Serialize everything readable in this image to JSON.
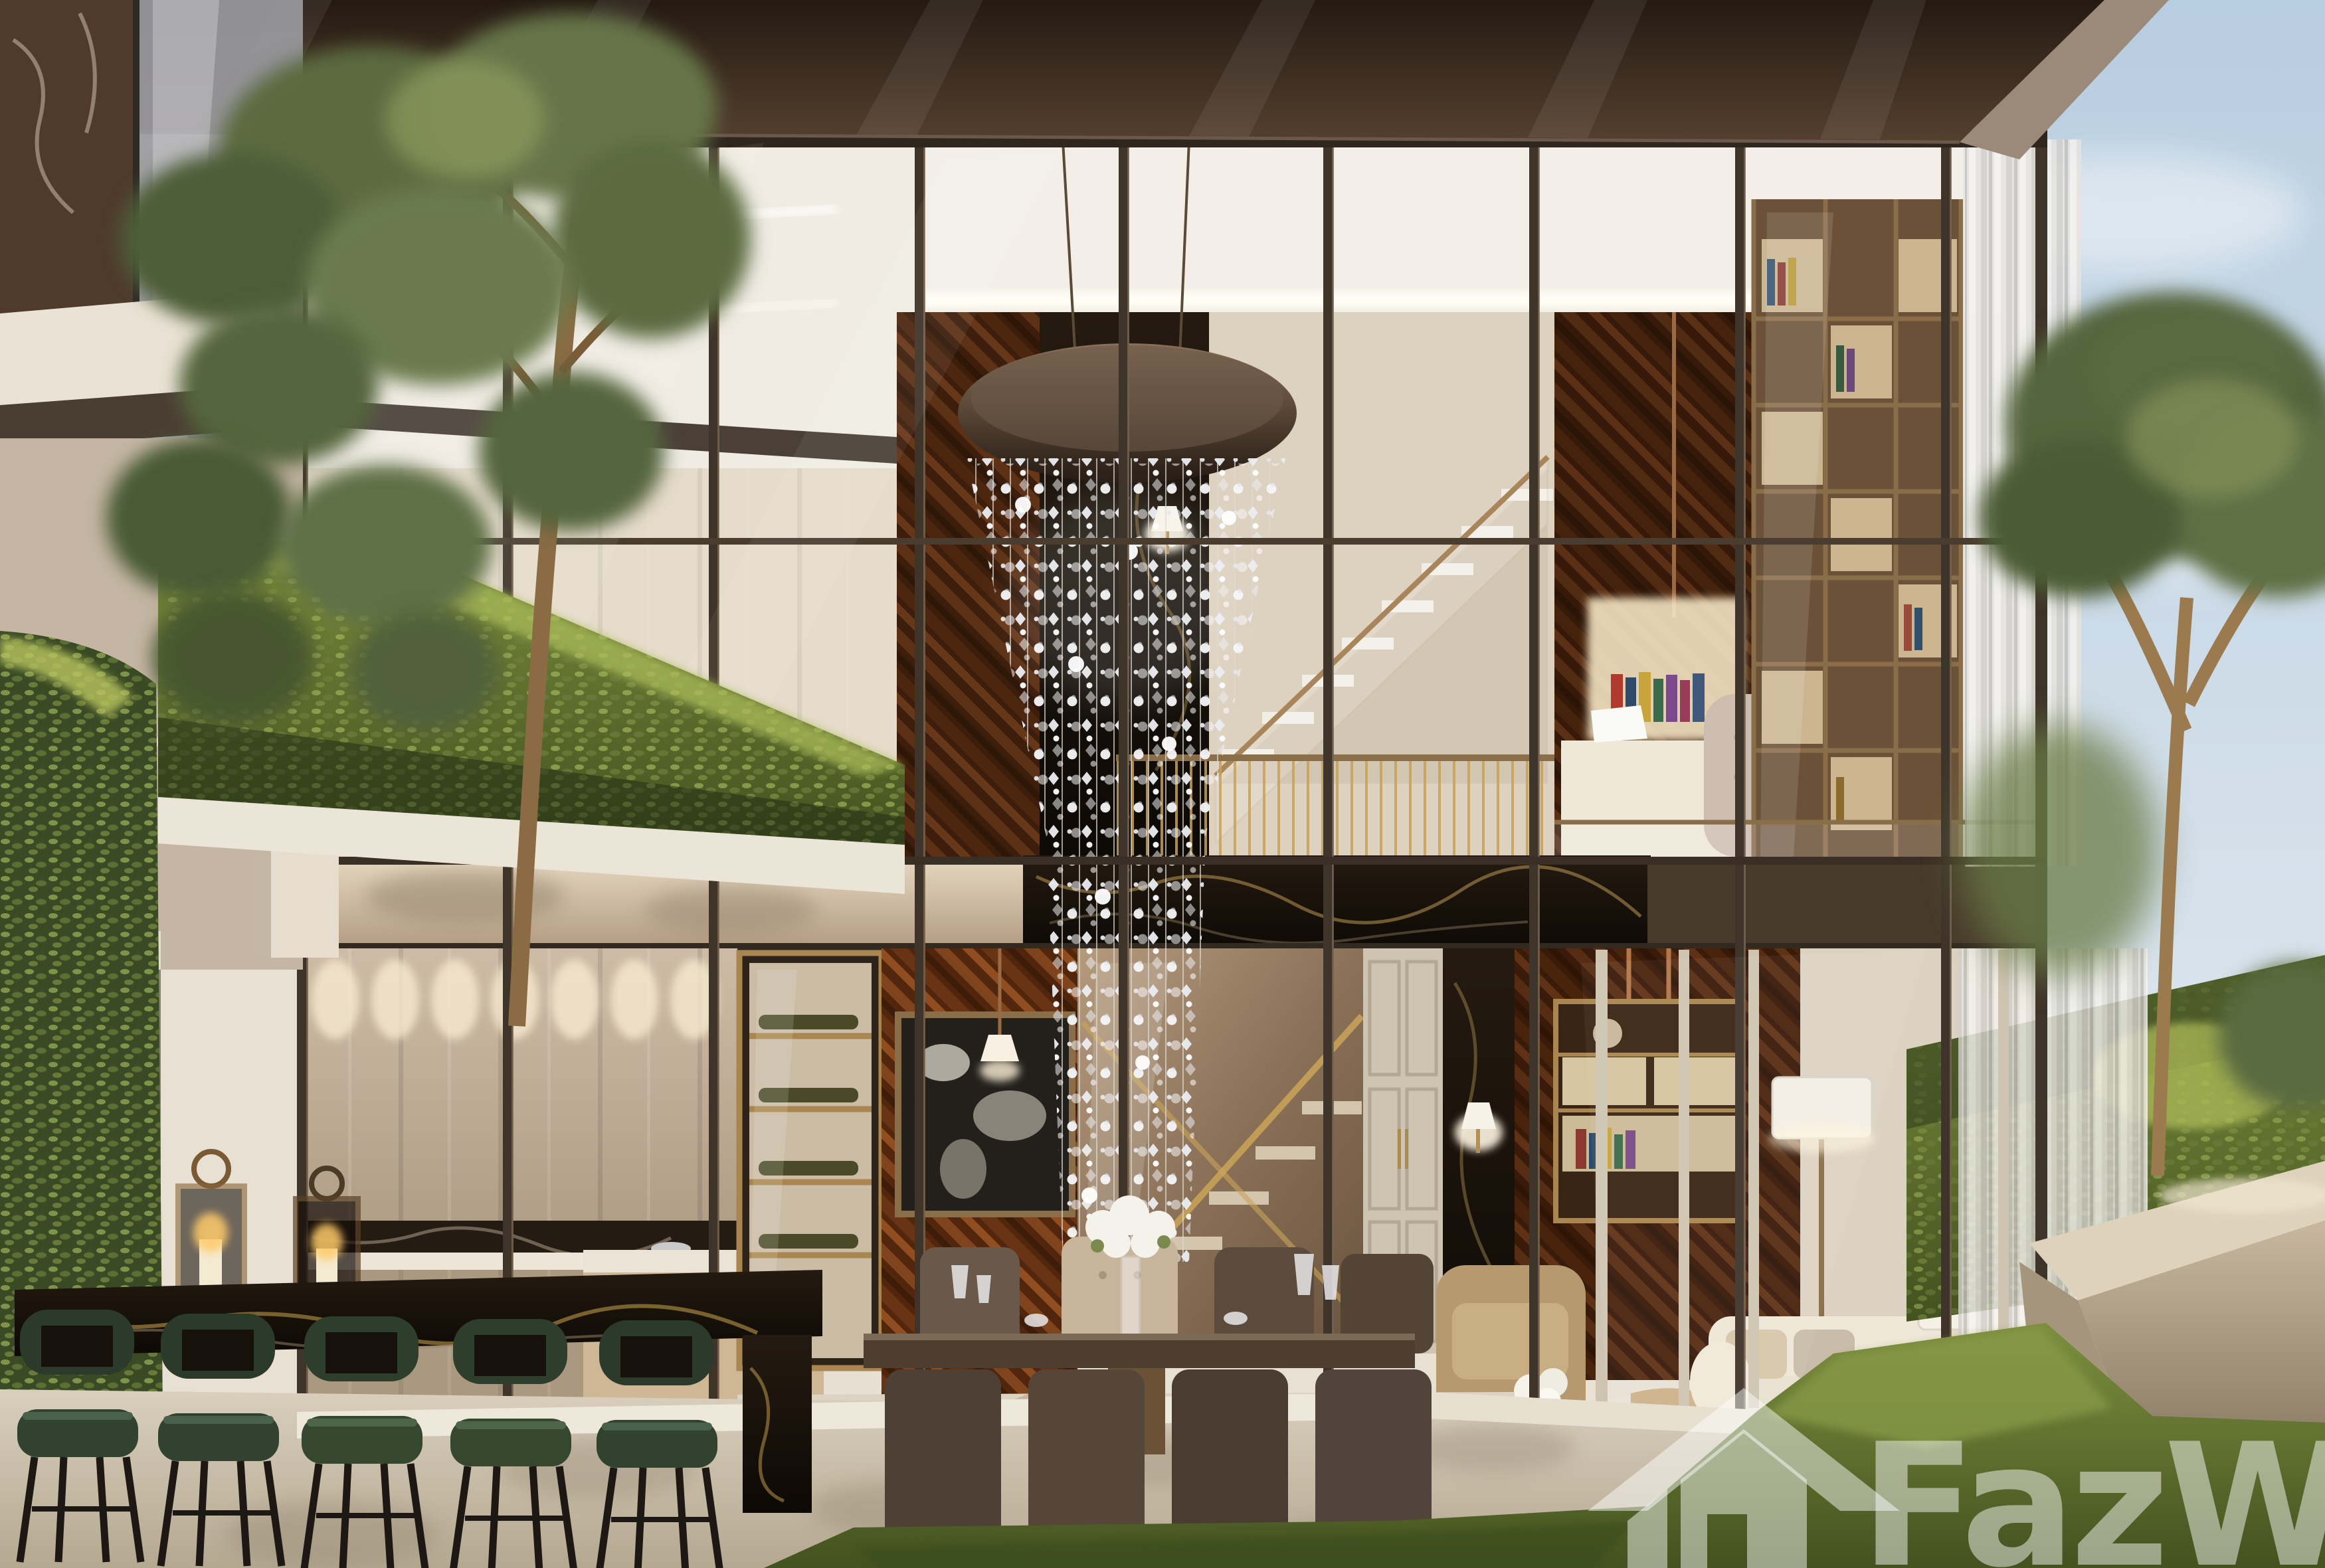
{
  "image": {
    "kind": "architectural-3d-render",
    "subject": "Two-storey luxury duplex villa with double-height glass facade, crystal cascade chandelier, kitchen bar, dining room, living room and garden"
  },
  "watermark": {
    "text": "FazWaz",
    "icon": "fazwaz-house-logo-icon",
    "color": "#ffffff",
    "opacity": 0.48
  },
  "palette": {
    "sky_top": "#b7cde0",
    "sky_bottom": "#e9eef2",
    "roof_dark": "#241a12",
    "roof_light": "#55402f",
    "roof_fascia": "#9b8979",
    "mullion": "#3f3429",
    "ceiling_white": "#f3efe8",
    "cream_wall": "#ddd2c0",
    "slab_beige": "#d8c7b1",
    "dark_wood": "#38200d",
    "chevron_wood": "#8a4a1e",
    "black_marble": "#170f08",
    "brass": "#c8a055",
    "kitchen_cabinet": "#c6b4a0",
    "counter_white": "#ece5d8",
    "hedge_dark": "#2c3a1c",
    "hedge_mid": "#55652f",
    "hedge_light": "#96a84f",
    "tree_olive": "#5c6b41",
    "trunk_brown": "#8a6b43",
    "lawn_dark": "#43521f",
    "lawn_light": "#7d8f3f",
    "travertine": "#cdc3b2",
    "sofa_cream": "#e9e1d1",
    "leather_tan": "#b6996f",
    "stool_green": "#2b3a2c",
    "crystal": "#f2f2f4"
  },
  "scene_regions": [
    {
      "id": "left-building",
      "label": "adjacent balcony building with marble panel and ivy wall"
    },
    {
      "id": "left-tree",
      "label": "tall tree in front of facade"
    },
    {
      "id": "upper-floor",
      "label": "double-height hall with chandelier, stair, study and library"
    },
    {
      "id": "kitchen",
      "label": "kitchen with taupe cabinets, island and black marble bar with green stools"
    },
    {
      "id": "dining",
      "label": "dining table for eight with white hydrangea centerpiece"
    },
    {
      "id": "living",
      "label": "living room with cream sofa, tan armchairs and lamps"
    },
    {
      "id": "garden",
      "label": "hedges, stone planter bench, lawn and trees under blue sky"
    }
  ]
}
